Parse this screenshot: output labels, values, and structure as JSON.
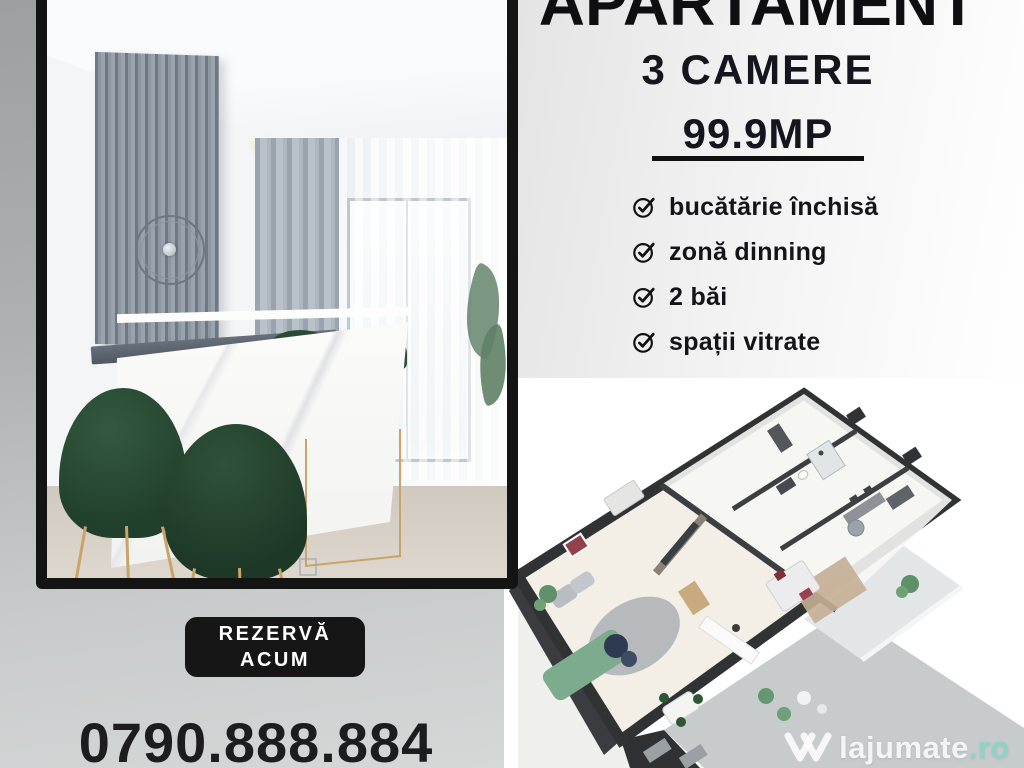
{
  "ad": {
    "title": "APARTAMENT",
    "subtitle": "3 CAMERE",
    "area": "99.9MP",
    "features": [
      {
        "label": "bucătărie închisă"
      },
      {
        "label": "zonă dinning"
      },
      {
        "label": "2 băi"
      },
      {
        "label": "spații vitrate"
      }
    ],
    "cta": {
      "line1": "REZERVĂ",
      "line2": "ACUM"
    },
    "phone": "0790.888.884",
    "watermark": {
      "name": "lajumate",
      "tld": ".ro"
    }
  },
  "icons": {
    "feature_check": "circled-checkmark",
    "watermark_logo": "double-v-heart"
  },
  "colors": {
    "cta_background": "#161616",
    "cta_text": "#ffffff",
    "heading_text": "#0f0f12",
    "body_text": "#141418",
    "left_background_top": "#9da0a0",
    "left_background_bottom": "#d6d8d8",
    "right_background": "#f2f2f2",
    "floorplan_background": "#ffffff",
    "floorplan_walls": "#303234",
    "sofa_green": "#7cab8d",
    "chair_green": "#21402c",
    "watermark_tld": "#8ed3c6"
  }
}
